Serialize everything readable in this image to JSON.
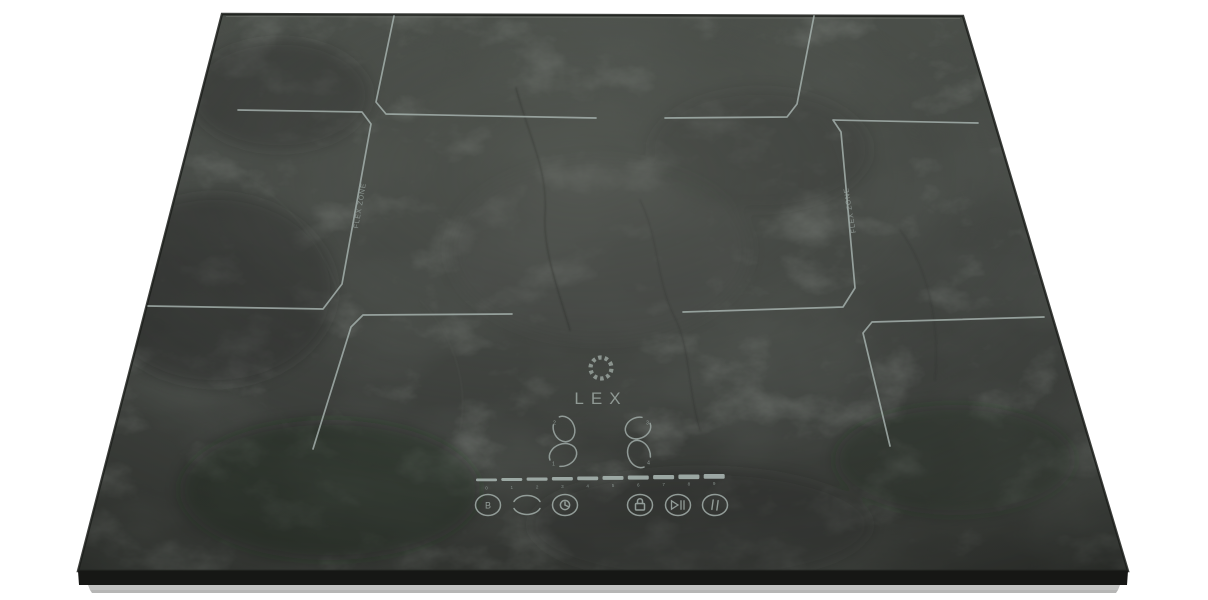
{
  "brand_logo": {
    "icon": "dotted-ring-icon",
    "text": "LEX"
  },
  "zone_labels": {
    "left": "FLEX ZONE",
    "right": "FLEX ZONE"
  },
  "controls": {
    "zone_selectors": [
      {
        "position": "back-left",
        "digit": "2"
      },
      {
        "position": "back-right",
        "digit": "3"
      },
      {
        "position": "front-left",
        "digit": "1"
      },
      {
        "position": "front-right",
        "digit": "4"
      }
    ],
    "power_slider": {
      "levels": [
        "0",
        "1",
        "2",
        "3",
        "4",
        "5",
        "6",
        "7",
        "8",
        "9"
      ]
    },
    "buttons": [
      {
        "name": "boost",
        "label": "B",
        "icon": "boost-b-icon"
      },
      {
        "name": "flex-bridge",
        "icon": "bridge-arcs-icon"
      },
      {
        "name": "timer",
        "icon": "timer-clock-icon"
      },
      {
        "name": "child-lock",
        "icon": "padlock-icon"
      },
      {
        "name": "stop-and-go",
        "icon": "play-pause-icon"
      },
      {
        "name": "pause",
        "icon": "pause-bars-icon"
      }
    ]
  },
  "colors": {
    "background": "#ffffff",
    "glass_base": "#3f423e",
    "zone_line": "#aab7b3",
    "panel_icon": "#9aa5a1",
    "logo": "#8f9994",
    "base_strip": "#b9bab8"
  }
}
